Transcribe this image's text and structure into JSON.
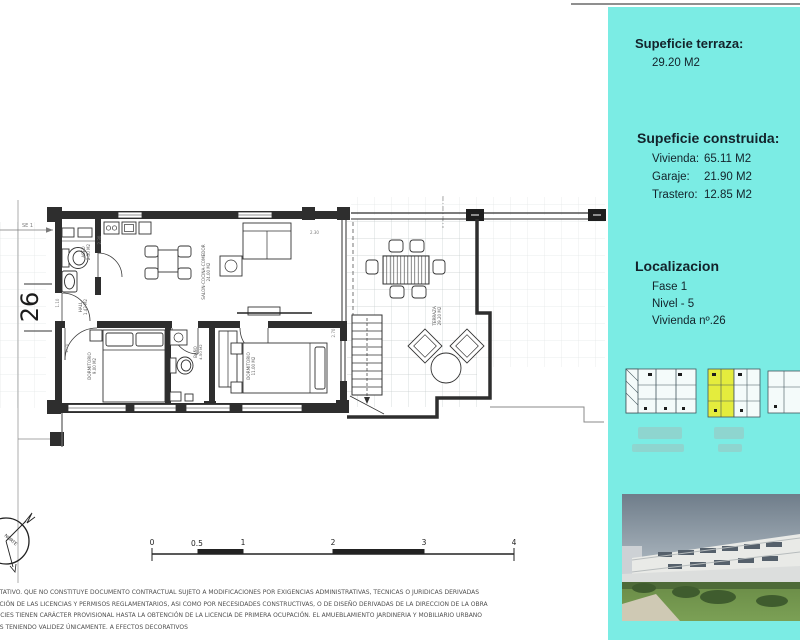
{
  "colors": {
    "sidebar_bg": "#7BECE4",
    "highlight_yellow": "#E4EC3D",
    "plan_line": "#2E2E2E",
    "top_rule": "#8F8F8F"
  },
  "sidebar": {
    "terrace": {
      "title": "Supeficie terraza:",
      "value": "29.20 M2"
    },
    "built": {
      "title": "Supeficie construida:",
      "items": [
        {
          "label": "Vivienda:",
          "value": "65.11 M2"
        },
        {
          "label": "Garaje:",
          "value": "21.90 M2"
        },
        {
          "label": "Trastero:",
          "value": "12.85 M2"
        }
      ]
    },
    "location": {
      "title": "Localizacion",
      "items": [
        "Fase 1",
        "Nivel - 5",
        "Vivienda nº.26"
      ]
    }
  },
  "plan": {
    "unit_number": "26",
    "grid_label": "SE 1",
    "north_label": "NORTE",
    "rooms": {
      "aseo": {
        "name": "ASEO",
        "area": "2.50 M2"
      },
      "hall": {
        "name": "HALL",
        "area": "1.43 M2"
      },
      "salon": {
        "name": "SALON-COCINA-COMEDOR",
        "area": "24.00 M2"
      },
      "dorm1": {
        "name": "DORMITORIO",
        "area": "9.00 M2"
      },
      "bano": {
        "name": "BAÑO",
        "area": "4.50 M2"
      },
      "dorm2": {
        "name": "DORMITORIO",
        "area": "11.00 M2"
      },
      "terraza": {
        "name": "TERRAZA",
        "area": "29.20 M2"
      }
    },
    "dimensions": [
      "2.30",
      "2.30",
      "2.70",
      "1.10",
      "2.20"
    ],
    "scale_ticks": [
      "0",
      "0.5",
      "1",
      "2",
      "3",
      "4"
    ]
  },
  "disclaimer": {
    "lines": [
      "NTATIVO. QUE NO CONSTITUYE DOCUMENTO CONTRACTUAL SUJETO A MODIFICACIONES POR EXIGENCIAS ADMINISTRATIVAS, TECNICAS O JURIDICAS DERIVADAS",
      "NCIÓN DE LAS LICENCIAS Y PERMISOS REGLAMENTARIOS, ASI COMO POR NECESIDADES CONSTRUCTIVAS, O DE DISEÑO DERIVADAS DE LA DIRECCION DE LA OBRA",
      "FICIES TIENEN CARÁCTER PROVISIONAL HASTA LA OBTENCIÓN DE LA LICENCIA DE PRIMERA OCUPACIÓN. EL AMUEBLAMIENTO JARDINERIA Y MOBILIARIO URBANO",
      "OS TENIENDO VALIDEZ ÚNICAMENTE. A EFECTOS DECORATIVOS"
    ]
  }
}
